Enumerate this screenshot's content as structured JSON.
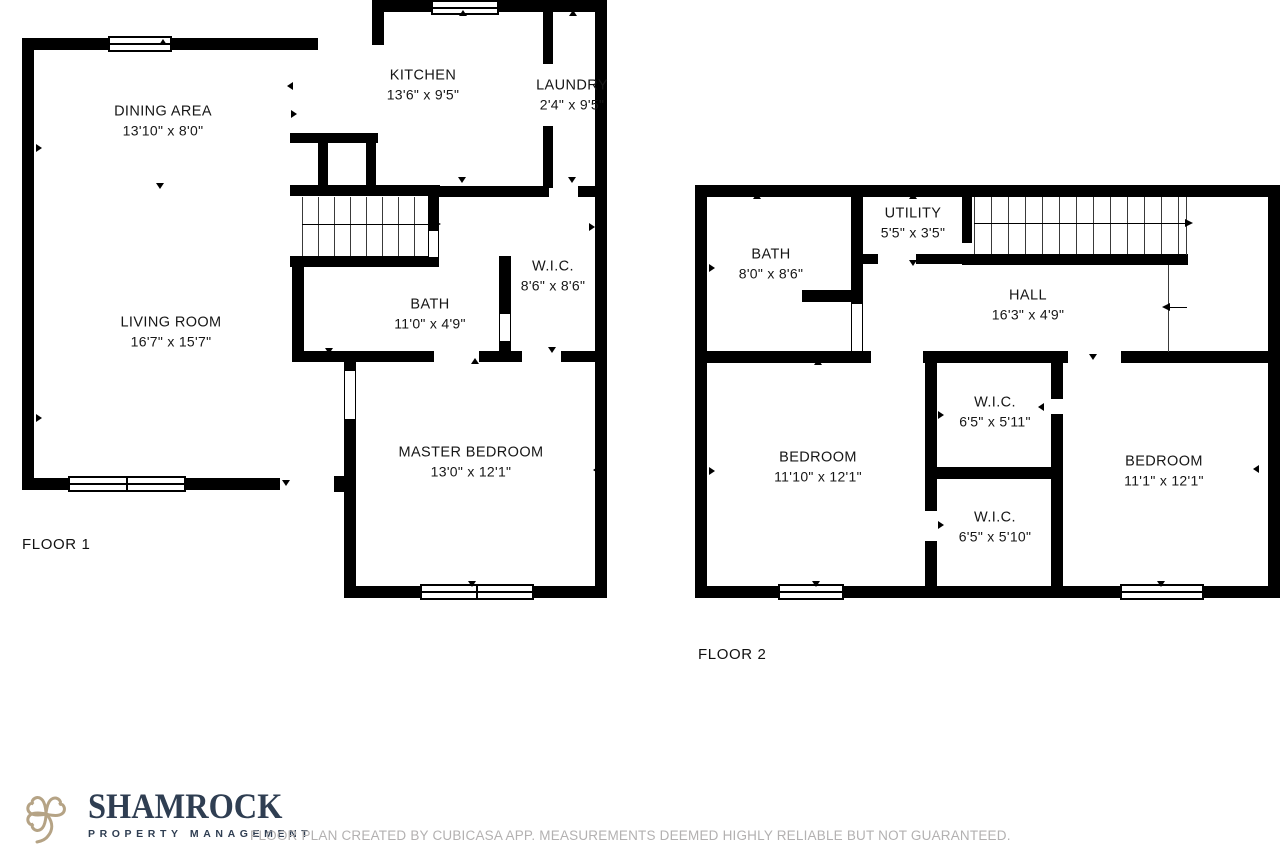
{
  "floor1": {
    "label": "FLOOR 1",
    "rooms": [
      {
        "name": "DINING AREA",
        "dims": "13'10\" x 8'0\""
      },
      {
        "name": "KITCHEN",
        "dims": "13'6\" x 9'5\""
      },
      {
        "name": "LAUNDRY",
        "dims": "2'4\" x 9'5\""
      },
      {
        "name": "LIVING ROOM",
        "dims": "16'7\" x 15'7\""
      },
      {
        "name": "BATH",
        "dims": "11'0\" x 4'9\""
      },
      {
        "name": "W.I.C.",
        "dims": "8'6\" x 8'6\""
      },
      {
        "name": "MASTER BEDROOM",
        "dims": "13'0\" x 12'1\""
      }
    ]
  },
  "floor2": {
    "label": "FLOOR 2",
    "rooms": [
      {
        "name": "BATH",
        "dims": "8'0\" x 8'6\""
      },
      {
        "name": "UTILITY",
        "dims": "5'5\" x 3'5\""
      },
      {
        "name": "HALL",
        "dims": "16'3\" x 4'9\""
      },
      {
        "name": "BEDROOM",
        "dims": "11'10\" x 12'1\""
      },
      {
        "name": "W.I.C.",
        "dims": "6'5\" x 5'11\""
      },
      {
        "name": "W.I.C.",
        "dims": "6'5\" x 5'10\""
      },
      {
        "name": "BEDROOM",
        "dims": "11'1\" x 12'1\""
      }
    ]
  },
  "footer": {
    "brand_name": "SHAMROCK",
    "brand_tagline": "PROPERTY MANAGEMENT",
    "disclaimer": "FLOOR PLAN CREATED BY CUBICASA APP. MEASUREMENTS DEEMED HIGHLY RELIABLE BUT NOT GUARANTEED.",
    "colors": {
      "wall_black": "#000000",
      "brand_navy": "#2f3e52",
      "brand_gold": "#b5a385",
      "disclaimer_gray": "#b3b1b1"
    }
  }
}
